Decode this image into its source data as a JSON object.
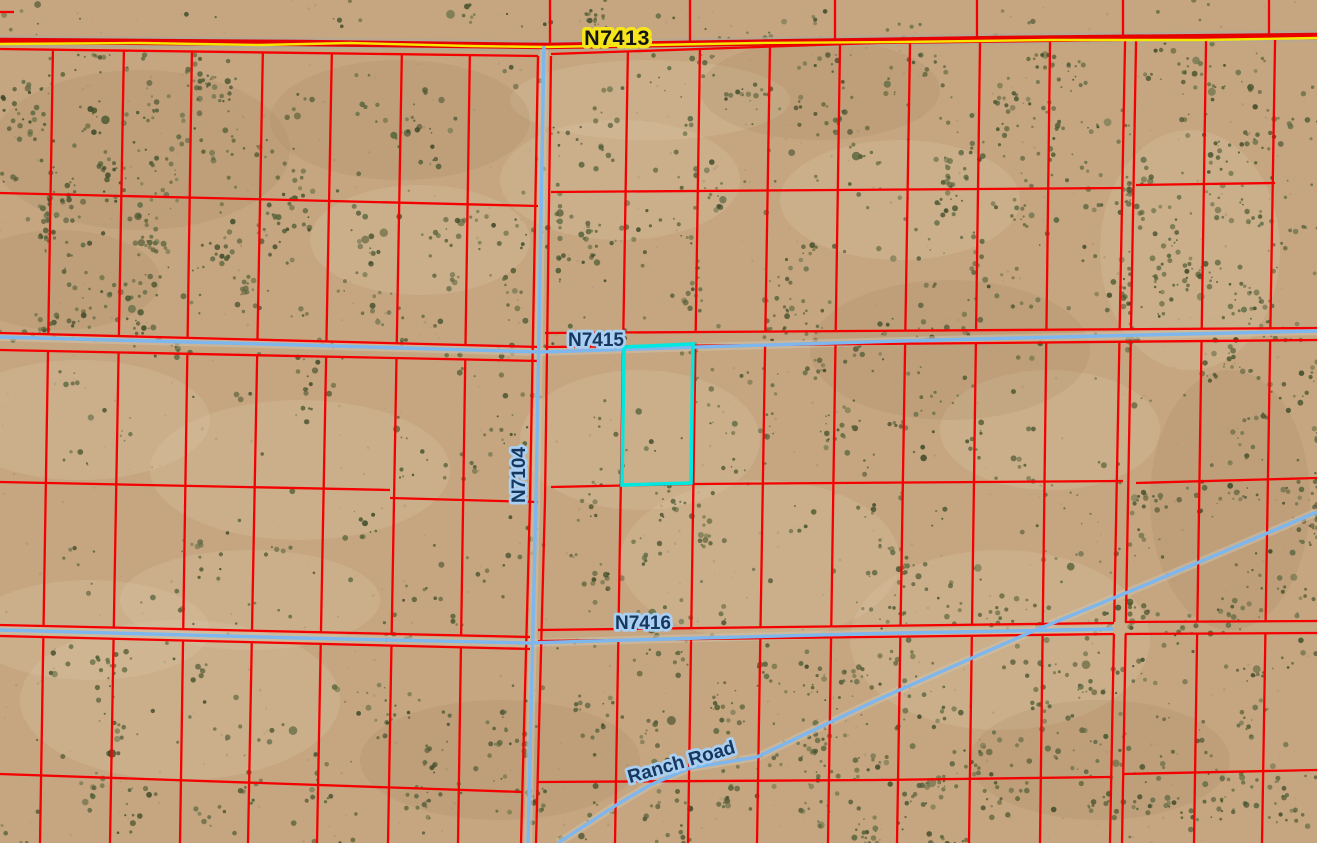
{
  "map": {
    "view": "aerial-imagery-with-parcel-overlay",
    "roads": {
      "n7413": {
        "label": "N7413",
        "class": "primary",
        "label_style": "yellow-halo"
      },
      "n7415": {
        "label": "N7415",
        "class": "local",
        "label_style": "blue-halo"
      },
      "n7104": {
        "label": "N7104",
        "class": "local",
        "label_style": "blue-halo",
        "label_rotation": "vertical"
      },
      "n7416": {
        "label": "N7416",
        "class": "local",
        "label_style": "blue-halo"
      },
      "ranch_road": {
        "label": "Ranch Road",
        "class": "local",
        "label_style": "blue-halo",
        "label_rotation": "diagonal"
      }
    },
    "selected_parcel": {
      "highlighted": true,
      "outline_color": "#00e8e0"
    },
    "colors": {
      "parcel_line": "#f50000",
      "highlight": "#00e8e0",
      "road_line": "#7db7ed",
      "road_major_casing": "#e60000",
      "road_major_fill": "#f7e600",
      "label_text": "#16375e",
      "label_halo": "#a9cff2",
      "major_label_text": "#141414",
      "major_label_halo": "#f5e51a",
      "terrain": "#c5a681",
      "terrain_light": "#dac5a3",
      "terrain_dark": "#aa8a64",
      "vegetation": "#4a5730",
      "speckle": "#9c8663",
      "track": "#cec0a8",
      "track_major": "#b3a694"
    }
  }
}
